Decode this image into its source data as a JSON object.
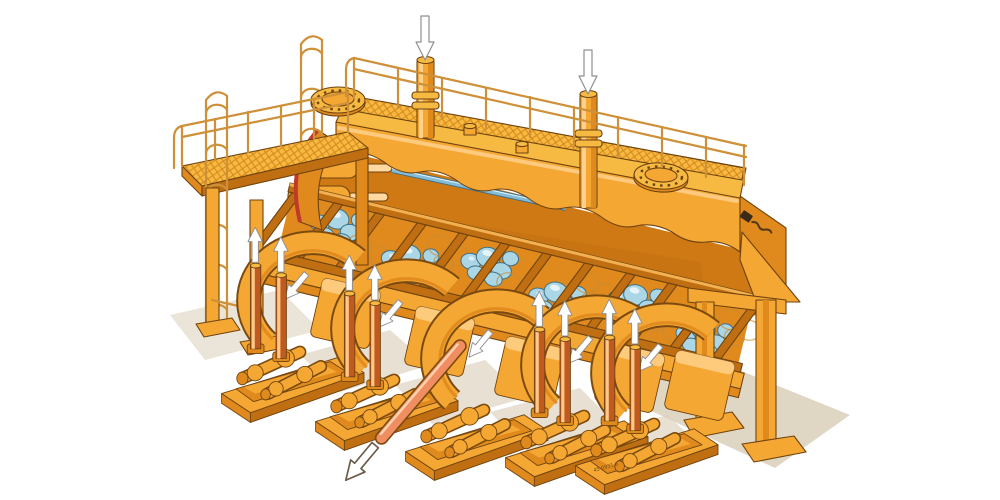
{
  "page": {
    "background": "#FFFFFF"
  },
  "illustration": {
    "alt": "Isometric cutaway illustration of an orange multi-stand tube rolling mill: long top tank with mesh service walkway, perimeter railings, two caged ladders, two bolted manhole covers and two inlet pipes marked with white down arrows; an inclined rack holding blue three-roll stands; five front drive units on sole plates with gearboxes, articulated spindles and paired lifting cylinders marked with white up arrows; a salmon product pipe exiting at the front with an outlined arrow; machine stands on legs over a beige floor shadow",
    "drawing_number": "45 0931 a"
  },
  "annotations": {
    "inlet_down_arrows": 2,
    "spindle_up_arrows": 8,
    "housing_swing_arrows": 5,
    "product_exit_arrows": 1,
    "manhole_covers": 2,
    "cage_ladders": 2,
    "drive_units": 5,
    "roll_stand_clusters": 6
  },
  "icons": {
    "flow-down-arrow": "white arrow pointing down above each inlet pipe",
    "spindle-up-arrow": "white arrow pointing up above each lifting cylinder",
    "swing-arrow": "white arrow pointing down-left on each stand housing",
    "exit-arrow": "outlined white arrow at tip of exiting product pipe",
    "manhole-cover": "round bolted cover on tank top",
    "cage-ladder": "vertical ladder with safety cage",
    "manufacturer-logo": "small dark wordmark on right side panel (illegible)"
  },
  "colors": {
    "c-body": "#F5A733",
    "c-body-light": "#FFD08A",
    "c-shade": "#E08A1E",
    "c-shade-deep": "#C06E12",
    "c-deck": "#F6BA42",
    "c-mesh-line": "#D8891B",
    "c-line": "#6E4310",
    "c-interior": "#CE7914",
    "c-roller": "#ABD6E6",
    "c-roller-line": "#3E7086",
    "c-shaft": "#85BCD8",
    "c-pipe": "#F08E62",
    "c-pipe-hi": "#FFD2B0",
    "c-rail": "#CE9038",
    "c-ground": "#DBCFBA",
    "c-arrow": "#FFFFFF",
    "c-arrow-line": "#8F8F8F",
    "c-spindle": "#C05A1E",
    "c-spindle-hi": "#FFC887",
    "c-logo": "#3A2A18",
    "c-bg": "#FFFFFF"
  }
}
